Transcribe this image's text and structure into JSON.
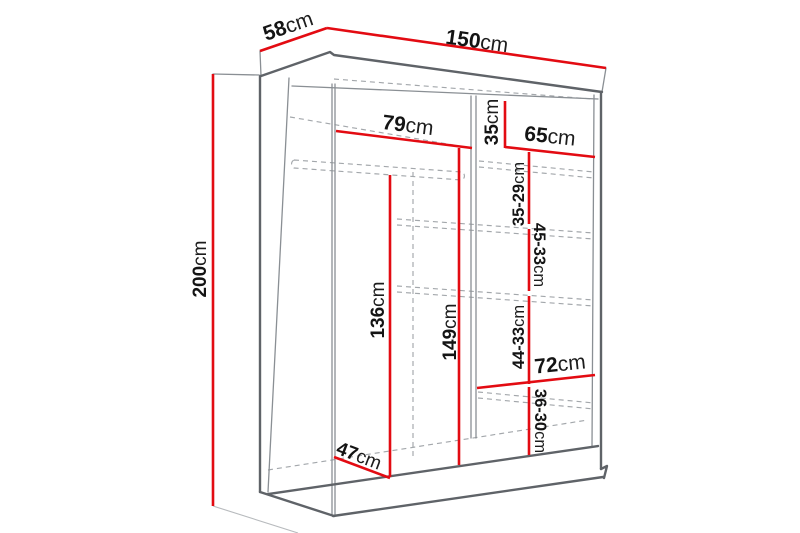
{
  "diagram": {
    "subject": "sliding-door wardrobe dimension diagram",
    "background_color": "#ffffff",
    "dimension_line_color": "#e30b12",
    "outline_color": "#5f6368",
    "dashed_shelf_color": "#a3a7ab",
    "text_color": "#141414",
    "dimensions": {
      "depth": {
        "num": "58",
        "unit": "cm"
      },
      "width": {
        "num": "150",
        "unit": "cm"
      },
      "height": {
        "num": "200",
        "unit": "cm"
      },
      "left_top_width": {
        "num": "79",
        "unit": "cm"
      },
      "top_right_gap": {
        "num": "35",
        "unit": "cm"
      },
      "right_width_top": {
        "num": "65",
        "unit": "cm"
      },
      "right_gap_1": {
        "num": "35-29",
        "unit": "cm"
      },
      "right_gap_2": {
        "num": "45-33",
        "unit": "cm"
      },
      "right_gap_3": {
        "num": "44-33",
        "unit": "cm"
      },
      "right_width_low": {
        "num": "72",
        "unit": "cm"
      },
      "right_gap_4": {
        "num": "36-30",
        "unit": "cm"
      },
      "left_height_b": {
        "num": "149",
        "unit": "cm"
      },
      "left_height_a": {
        "num": "136",
        "unit": "cm"
      },
      "inner_depth": {
        "num": "47",
        "unit": "cm"
      }
    }
  }
}
